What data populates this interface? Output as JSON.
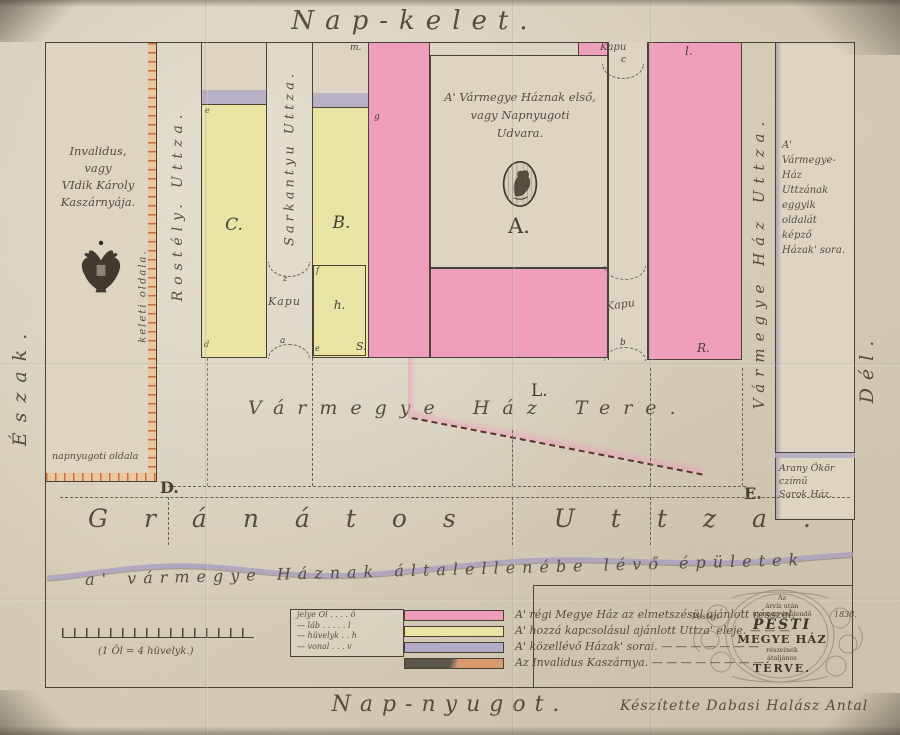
{
  "compass": {
    "east": "Nap-kelet.",
    "west": "Nap-nyugot.",
    "north": "Észak.",
    "south": "Dél."
  },
  "streets": {
    "rostely": "Rostély. Uttza.",
    "sarkantyu": "Sarkantyu Uttza.",
    "varmegye": "Vármegye Ház Uttza.",
    "granatos": "Gránátos Uttza.",
    "square": "Vármegye Ház Tere.",
    "square_label": "L."
  },
  "courtyard": {
    "caption": "A' Vármegye Háznak első,\nvagy Napnyugoti\nUdvara.",
    "label": "A.",
    "lion_emblem": "lion-seal"
  },
  "invalidus": {
    "caption": "Invalidus,\nvagy\nVIdik Károly\nKaszárnyája.",
    "east_side": "keleti oldala.",
    "west_side": "napnyugoti oldala",
    "eagle_emblem": "double-headed-eagle"
  },
  "right_block": {
    "caption": "A' Vármegye-Ház Uttzának eggyik oldalát képző Házak' sora.",
    "corner_house": "Arany Ökör\nczímű\nSarok Ház."
  },
  "blocks": {
    "b": "B.",
    "c": "C.",
    "h": "h."
  },
  "gates": {
    "label": "Kapu"
  },
  "markers": {
    "a": "a",
    "b": "b",
    "c": "c",
    "d": "d",
    "e": "e",
    "f": "f",
    "g": "g",
    "m": "m.",
    "l": "l.",
    "r": "R.",
    "s": "S.",
    "z": "z",
    "big_d": "D.",
    "big_e": "E."
  },
  "opposite_caption": "a' vármegye Háznak általellenébe lévő épületek",
  "legend": {
    "units": {
      "row1": "jelye Öl . . . . ö",
      "row2": "—  láb . . . . . l",
      "row3": "—  hüvelyk . . h",
      "row4": "—  vonal . . . v"
    },
    "items": [
      {
        "color": "#ee9cba",
        "label": "A' régi Megye Ház az elmetszésül ajánlott résszel."
      },
      {
        "color": "#e9e3a4",
        "label": "A' hozzá kapcsolásul ajánlott Uttza' eleje. — — —"
      },
      {
        "color": "#b2aac6",
        "label": "A' közellévő Házak' sorai. — — — — — — —"
      },
      {
        "color": "linear-gradient(105deg, #5b564c 46%, #d89a6e 54%)",
        "label": "Az Invalidus Kaszárnya. — — — — — — — —"
      }
    ]
  },
  "scalebar": {
    "caption": "(1 Öl = 4 hüvelyk.)"
  },
  "cartouche": {
    "place": "Pesten",
    "year": "1838.",
    "small1": "Az",
    "small2": "árvíz után",
    "small3": "újonnan épülendő",
    "title1": "PESTI",
    "title2": "MEGYE HÁZ",
    "small4": "részeinek",
    "small5": "átaljános",
    "title3": "TÉRVE."
  },
  "signature": "Készítette Dabasi Halász Antal",
  "palette": {
    "pink": "#ef9fbc",
    "yellow": "#e9e3a4",
    "purple": "#b2aac6",
    "brick": "#d89a6e",
    "ink": "#453e33",
    "paper": "#d9d1bd"
  }
}
